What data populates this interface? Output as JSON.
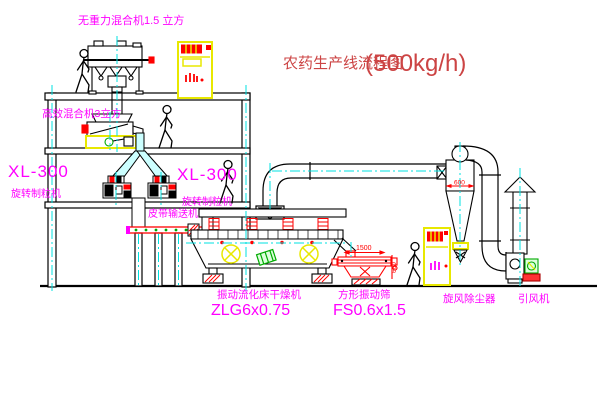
{
  "diagram": {
    "title": "农药生产线流程图",
    "capacity": "(500kg/h)"
  },
  "equipment_labels": {
    "gravity_free_mixer": "无重力混合机1.5 立方",
    "high_efficiency_mixer": "高效混合机3立方",
    "granulator_left": {
      "model": "XL-300",
      "name": "旋转制粒机"
    },
    "granulator_center": {
      "model": "XL-300",
      "name": "旋转制粒机"
    },
    "belt_conveyor": "皮带输送机",
    "fluid_bed_dryer": {
      "name": "振动流化床干燥机",
      "model": "ZLG6x0.75"
    },
    "vibrating_screen": {
      "name": "方形振动筛",
      "model": "FS0.6x1.5"
    },
    "cyclone": "旋风除尘器",
    "induced_draft_fan": "引风机"
  },
  "dimensions": {
    "screen_length": "1500",
    "screen_height": "600",
    "cyclone_diameter": "600"
  },
  "colors": {
    "background": "#ffffff",
    "line_black": "#000000",
    "centerline_cyan": "#00e0e0",
    "label_magenta": "#ff00ff",
    "title_red": "#cc4444",
    "detail_red": "#ff0000",
    "equipment_yellow": "#e8e800",
    "accent_green": "#00aa00"
  }
}
